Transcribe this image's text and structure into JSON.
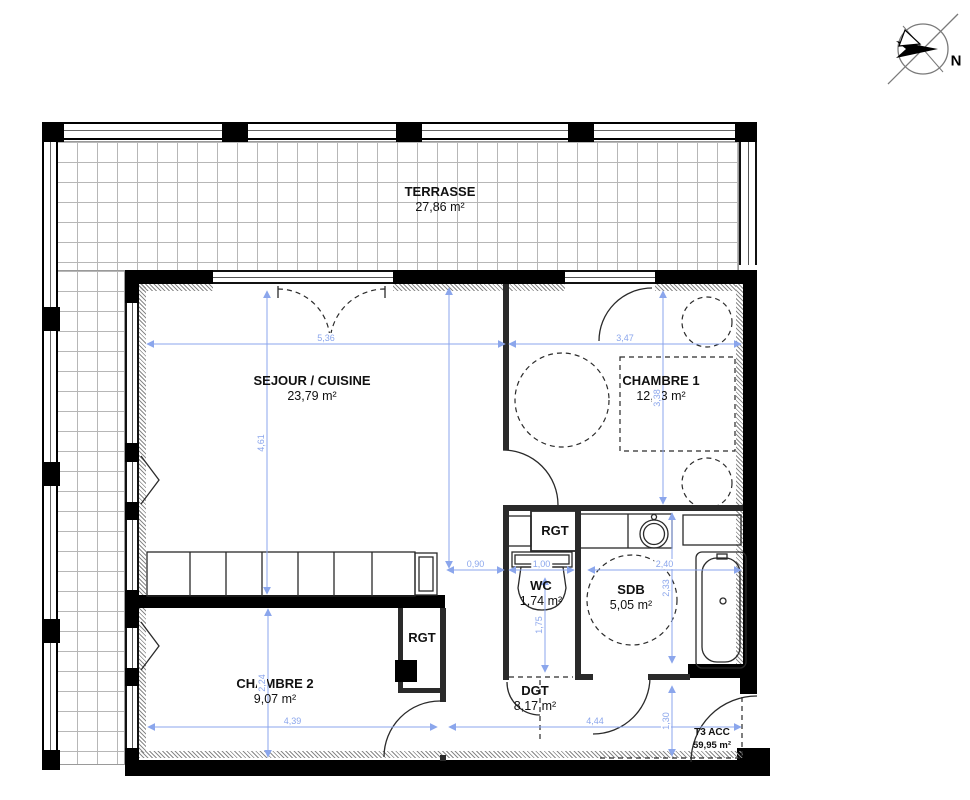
{
  "compass": {
    "label": "N"
  },
  "colors": {
    "dim": "#8ba6ec",
    "wall": "#000000",
    "grid": "#b7b7b7"
  },
  "rooms": [
    {
      "id": "terrasse",
      "name": "TERRASSE",
      "area": "27,86 m²",
      "x": 440,
      "y": 200
    },
    {
      "id": "sejour",
      "name": "SEJOUR / CUISINE",
      "area": "23,79 m²",
      "x": 312,
      "y": 389
    },
    {
      "id": "chambre1",
      "name": "CHAMBRE 1",
      "area": "12,13 m²",
      "x": 661,
      "y": 389
    },
    {
      "id": "rgt1",
      "name": "RGT",
      "area": "",
      "x": 555,
      "y": 531
    },
    {
      "id": "wc",
      "name": "WC",
      "area": "1,74 m²",
      "x": 541,
      "y": 594
    },
    {
      "id": "sdb",
      "name": "SDB",
      "area": "5,05 m²",
      "x": 631,
      "y": 598
    },
    {
      "id": "rgt2",
      "name": "RGT",
      "area": "",
      "x": 422,
      "y": 638
    },
    {
      "id": "chambre2",
      "name": "CHAMBRE 2",
      "area": "9,07 m²",
      "x": 275,
      "y": 692
    },
    {
      "id": "dgt",
      "name": "DGT",
      "area": "8,17 m²",
      "x": 535,
      "y": 699
    },
    {
      "id": "t3",
      "name": "T3 ACC",
      "area": "59,95 m²",
      "x": 712,
      "y": 739
    }
  ],
  "dimensions": [
    {
      "label": "5,36",
      "orient": "h",
      "x1": 147,
      "x2": 505,
      "y": 344
    },
    {
      "label": "3,47",
      "orient": "h",
      "x1": 509,
      "x2": 741,
      "y": 344
    },
    {
      "label": "0,90",
      "orient": "h",
      "x1": 447,
      "x2": 504,
      "y": 570
    },
    {
      "label": "1,00",
      "orient": "h",
      "x1": 509,
      "x2": 574,
      "y": 570
    },
    {
      "label": "2,40",
      "orient": "h",
      "x1": 588,
      "x2": 741,
      "y": 570
    },
    {
      "label": "4,39",
      "orient": "h",
      "x1": 148,
      "x2": 437,
      "y": 727
    },
    {
      "label": "4,44",
      "orient": "h",
      "x1": 449,
      "x2": 741,
      "y": 727
    },
    {
      "label": "4,61",
      "orient": "v",
      "x": 267,
      "y1": 291,
      "y2": 594
    },
    {
      "label": "3,38",
      "orient": "v",
      "x": 663,
      "y1": 291,
      "y2": 504
    },
    {
      "label": "1,75",
      "orient": "v",
      "x": 545,
      "y1": 578,
      "y2": 672
    },
    {
      "label": "2,33",
      "orient": "v",
      "x": 672,
      "y1": 513,
      "y2": 663
    },
    {
      "label": "2,24",
      "orient": "v",
      "x": 268,
      "y1": 609,
      "y2": 757
    },
    {
      "label": "1,30",
      "orient": "v",
      "x": 672,
      "y1": 686,
      "y2": 756
    },
    {
      "label": "",
      "orient": "v",
      "x": 449,
      "y1": 288,
      "y2": 568
    }
  ]
}
